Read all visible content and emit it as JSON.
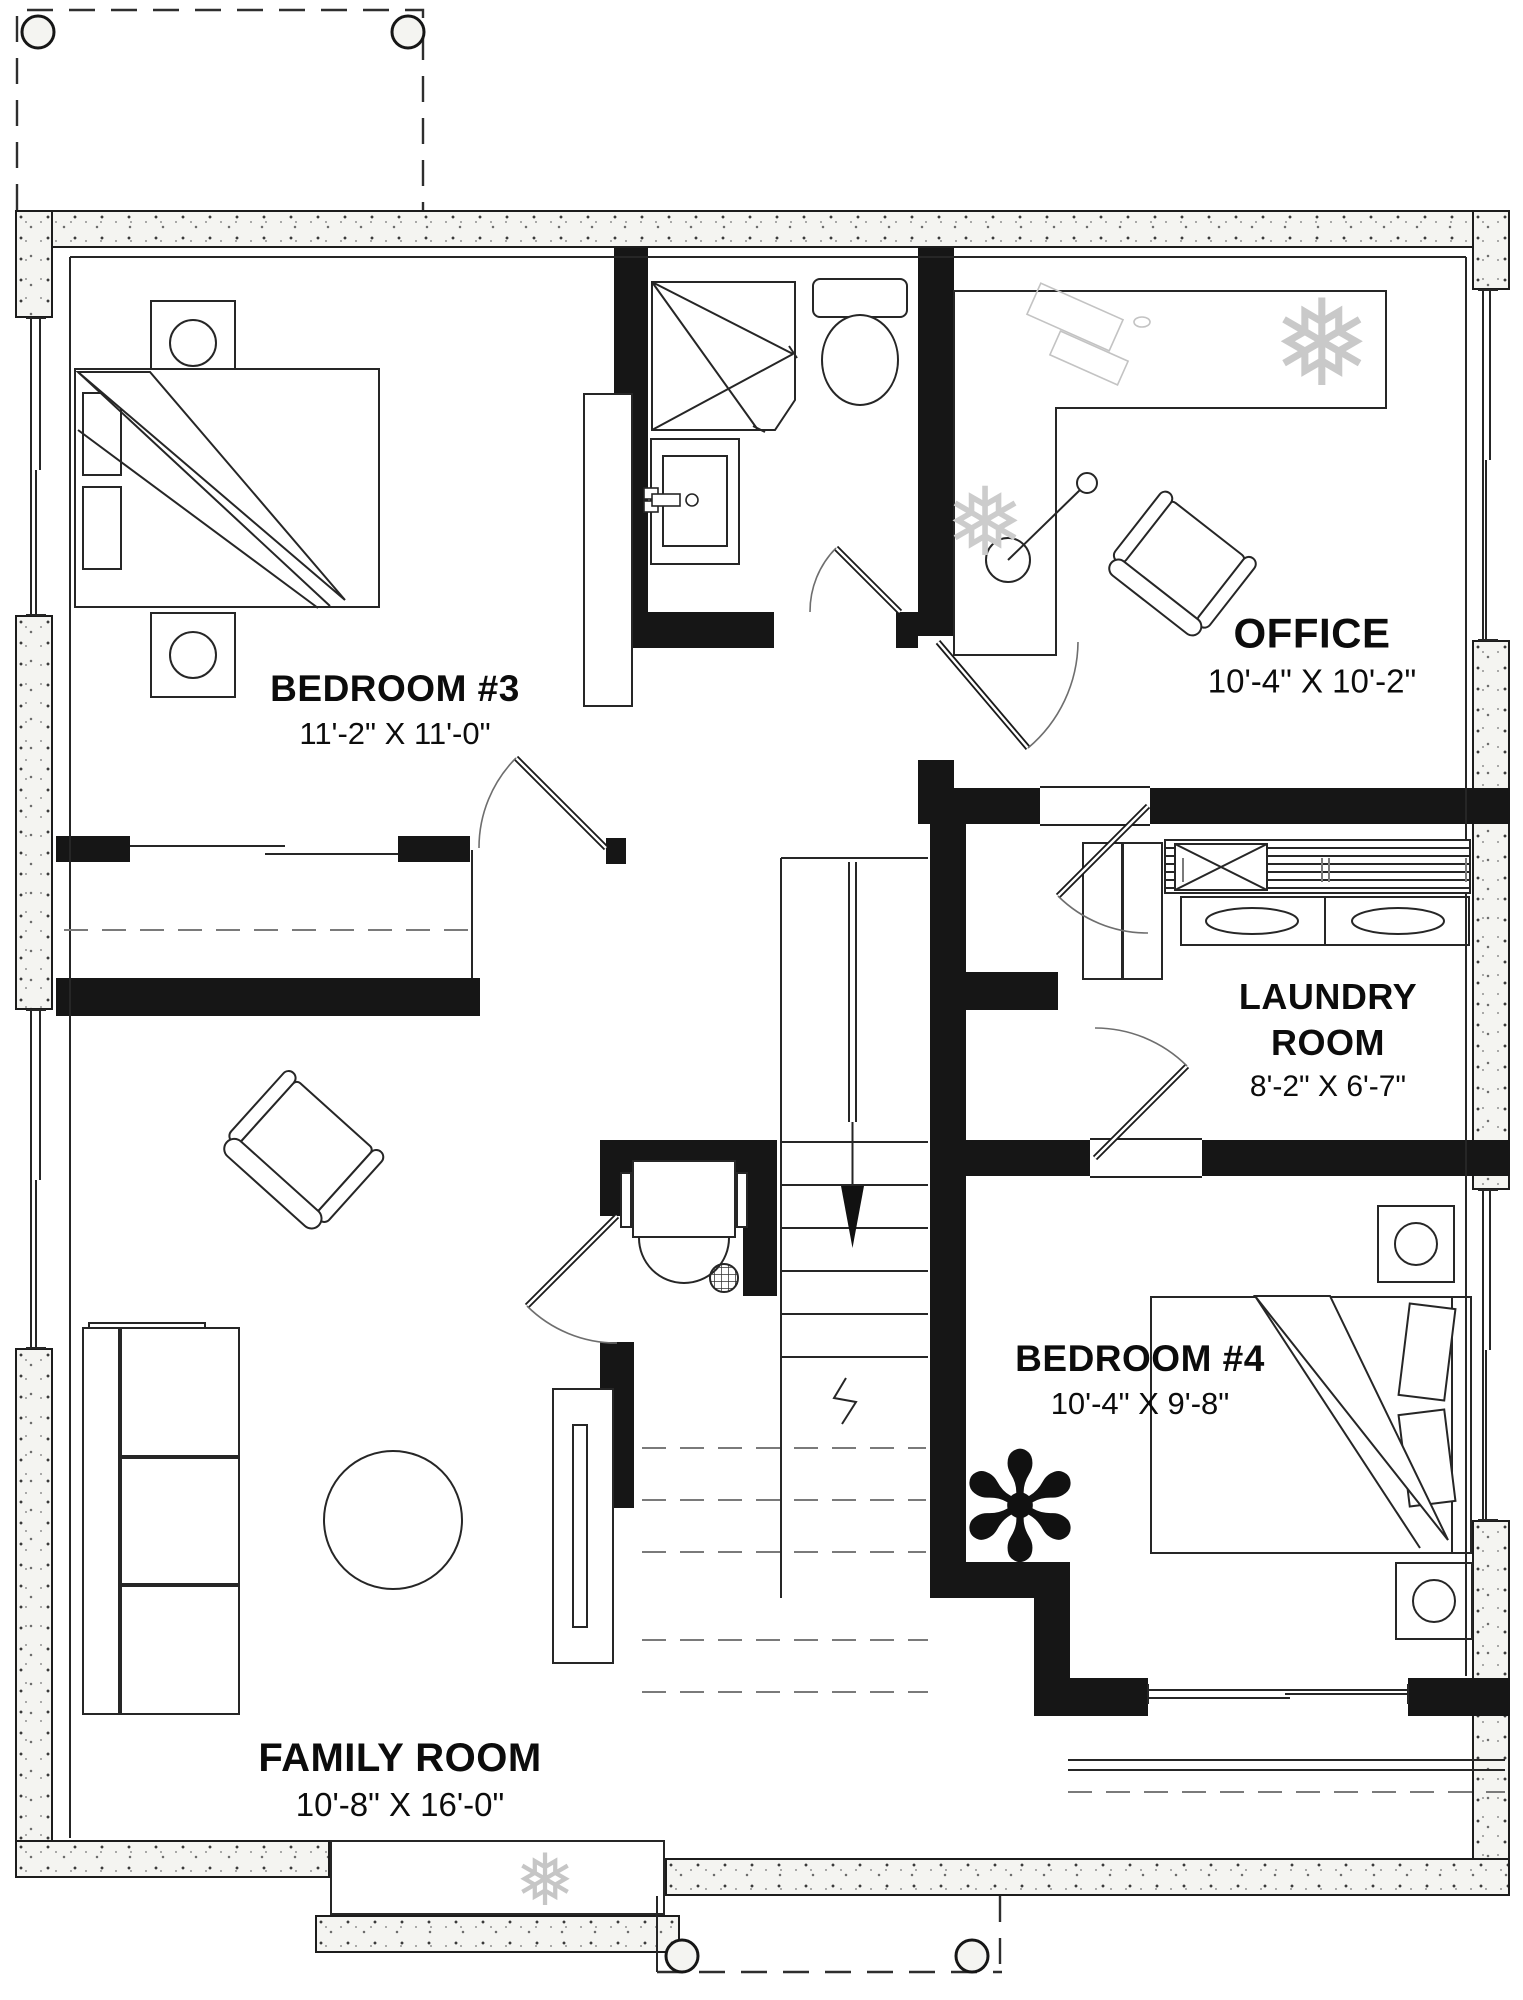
{
  "plan_type": "basement floor plan",
  "rooms": {
    "bedroom3": {
      "name": "BEDROOM #3",
      "dims": "11'-2\" X 11'-0\""
    },
    "office": {
      "name": "OFFICE",
      "dims": "10'-4\" X 10'-2\""
    },
    "laundry": {
      "name_line1": "LAUNDRY",
      "name_line2": "ROOM",
      "dims": "8'-2\" X 6'-7\""
    },
    "bedroom4": {
      "name": "BEDROOM #4",
      "dims": "10'-4\" X 9'-8\""
    },
    "family": {
      "name": "FAMILY ROOM",
      "dims": "10'-8\" X 16'-0\""
    }
  },
  "symbols": {
    "stairs": "stairs-down-arrow",
    "porch_columns": "round-column",
    "bathroom": [
      "corner-shower",
      "toilet",
      "vanity-sink"
    ],
    "laundry_fixtures": [
      "washer",
      "dryer",
      "wire-shelf"
    ],
    "plants": [
      "snowflake-plant",
      "leafy-plant"
    ]
  },
  "colors": {
    "wall": "#161616",
    "line": "#262626",
    "foundation_bg": "#f4f4f1",
    "light_sketch": "#c3c3c3"
  }
}
